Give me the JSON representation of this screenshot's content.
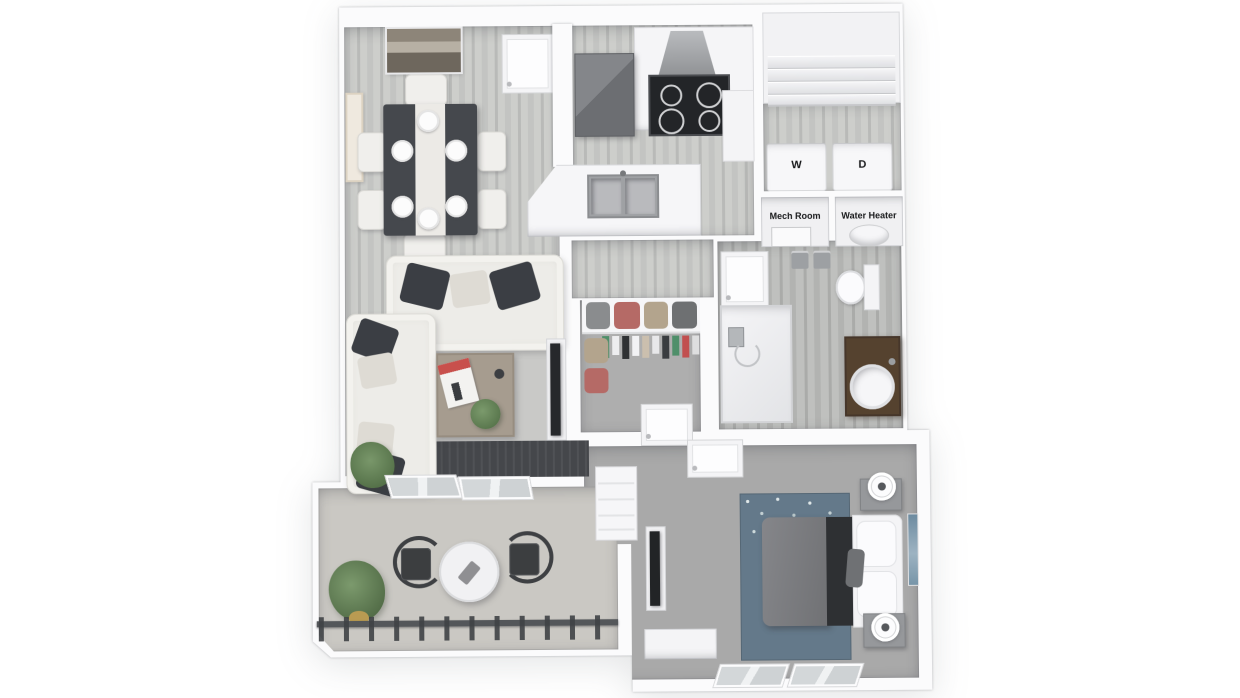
{
  "image_type": "3d-rendered-apartment-floor-plan",
  "labels": {
    "washer": "W",
    "dryer": "D",
    "mech_room": "Mech Room",
    "water_heater": "Water Heater"
  },
  "palette": {
    "bg": "#ffffff",
    "wall": "#fbfbfc",
    "wood-a": "#c3c4c2",
    "wood-b": "#cdcecb",
    "wood-c": "#b9bab8",
    "bath-a": "#b2b3b1",
    "bath-b": "#bfc0be",
    "carpet": "#a9a9a9",
    "carpet-closet": "#aeaeae",
    "patio": "#cac8c3",
    "rug-light": "#c9c9c7",
    "rug-dark": "#45474b",
    "bed-rug": "#64798a",
    "sofa": "#edece8",
    "pillow-dark": "#3b3e44",
    "pillow-light": "#dedbd4",
    "table-dark": "#45484d",
    "wood-table": "#a69c8f",
    "steel": "#76787b",
    "cooktop": "#232528",
    "vanity": "#55422f",
    "duvet": "#7b7c7e",
    "throw-dark": "#2e3033",
    "metal-dark": "#3e4043",
    "plant": "#5e7c51",
    "art-blue": "#6d8ba0",
    "label-text": "#17181a"
  }
}
